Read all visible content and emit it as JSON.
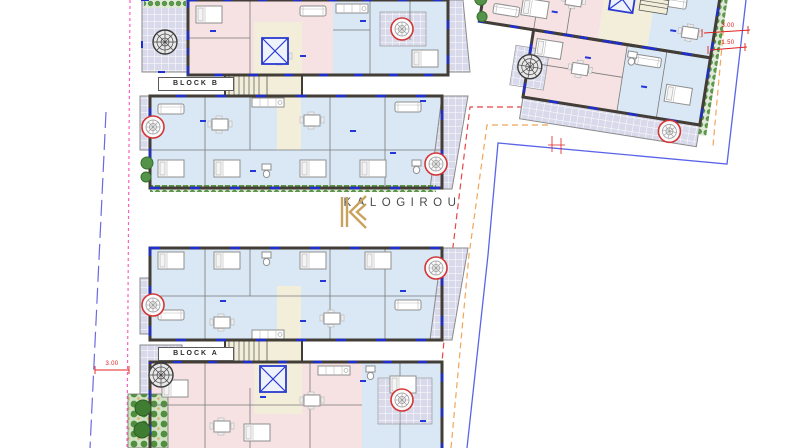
{
  "drawing": {
    "type": "architectural floor plan",
    "brand": {
      "monogram": "K",
      "name": "KALOGIROU"
    },
    "blocks": [
      {
        "id": "block-b",
        "label": "BLOCK B"
      },
      {
        "id": "block-a",
        "label": "BLOCK A"
      }
    ],
    "dimensions": {
      "right_outer": "3.00",
      "right_inner": "1.50",
      "left": "3.00"
    },
    "colors": {
      "room_blue": "#d9e8f4",
      "room_pink": "#f6e2e2",
      "core_cream": "#f2eeda",
      "balcony_lavender": "#d8d9ea",
      "wall_dark": "#423d36",
      "window_blue": "#1f2ecf",
      "boundary_red": "#e84545",
      "boundary_orange": "#f2a559",
      "boundary_blue": "#5a64e8",
      "boundary_pink": "#ff5fb8",
      "dimension_red": "#e02020",
      "plant_green": "#4f8f3e",
      "logo_gold": "#c9a35e",
      "logo_text": "#4a4a4a"
    },
    "icons": {
      "jacuzzi-icon": "red-ring circle with grey spiral",
      "spiral-stair-icon": "dark circle with radial spokes",
      "elevator-icon": "blue square with X",
      "stairs-icon": "parallel tread lines",
      "plant-icon": "green circle",
      "hedge-icon": "green dotted strip"
    },
    "boundaries": {
      "plot_line_red": "dashed red",
      "setback_line_orange": "dashed orange",
      "road_line_blue": "solid blue",
      "left_line_pink": "dashed pink",
      "left_line_blue": "long-dash blue"
    }
  }
}
